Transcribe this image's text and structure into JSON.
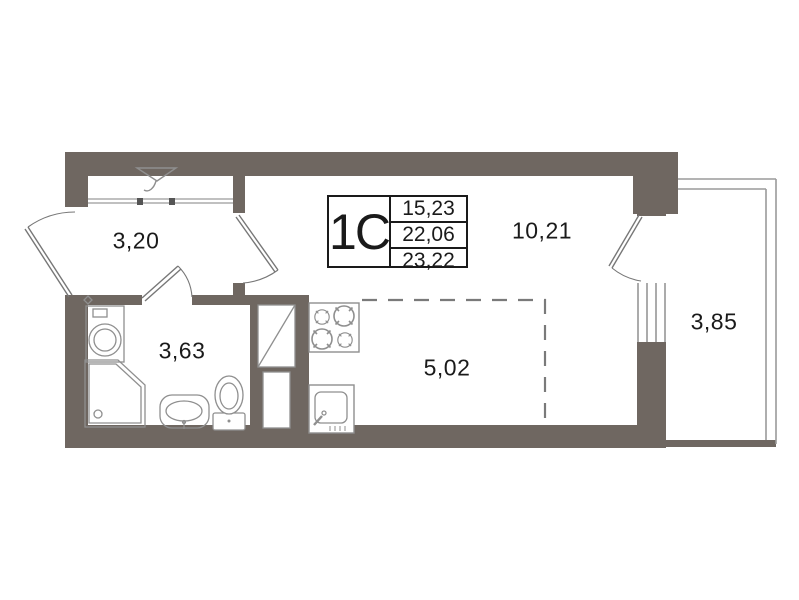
{
  "plan": {
    "unit_type": "1С",
    "legend": {
      "living_area": "15,23",
      "apartment_area": "22,06",
      "total_area": "23,22"
    },
    "rooms": {
      "hallway": {
        "area": "3,20"
      },
      "bathroom": {
        "area": "3,63"
      },
      "kitchen_zone": {
        "area": "5,02"
      },
      "living_room": {
        "area": "10,21"
      },
      "balcony": {
        "area": "3,85"
      }
    },
    "icons": [
      "hanger-icon",
      "washing-machine-icon",
      "shower-icon",
      "washbasin-icon",
      "toilet-icon",
      "stove-icon",
      "kitchen-sink-icon",
      "vent-shaft-icon",
      "door-swing-icon",
      "window-icon"
    ],
    "colors": {
      "wall": "#6F6761",
      "fixture_line": "#8F8F8F",
      "text": "#1A1A1A",
      "background": "#FFFFFF"
    }
  }
}
